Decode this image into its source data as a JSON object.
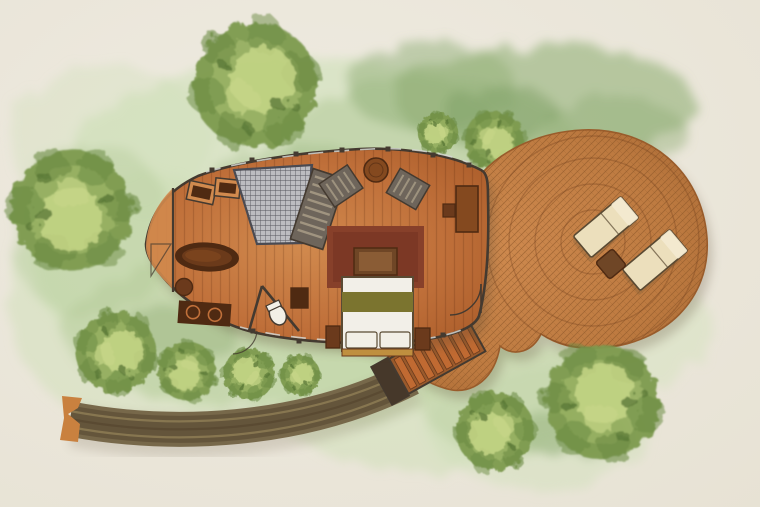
{
  "meta": {
    "title": "Watercolor top-down site plan of an oval treehouse cabin with round sun deck, staircase and curved boardwalk through a lawn with trees",
    "type": "illustrated-floor-plan",
    "style": "watercolor"
  },
  "counts": {
    "trees": 10,
    "sun_loungers": 2,
    "stair_steps": 8,
    "sinks": 2,
    "armchairs": 2,
    "pillows": 2,
    "nightstands": 2
  },
  "elements": {
    "site": [
      "lawn-wash",
      "trees",
      "curved-boardwalk",
      "boardwalk-end-cap"
    ],
    "cabin": [
      "oval-cabin-hull",
      "tip-balcony",
      "entry-grate",
      "slatted-daybed",
      "armchair-left",
      "armchair-right",
      "round-side-table",
      "console-table",
      "wall-stool",
      "storage-boxes",
      "bathtub",
      "bath-stool",
      "vanity-double-sink",
      "toilet-room",
      "toilet",
      "bath-cabinet",
      "area-rug",
      "ottoman",
      "double-bed",
      "bed-pillows",
      "nightstands",
      "interior-door",
      "bathroom-door"
    ],
    "deck": [
      "round-deck",
      "sun-loungers",
      "lounger-side-table",
      "staircase"
    ]
  },
  "colors": {
    "paper": "#efebe1",
    "paper_edge": "#e7e2d4",
    "wash_light": "#cfe0b8",
    "wash_mid": "#aec893",
    "wash_dark": "#92b077",
    "wash_deep": "#7fa065",
    "tree_light": "#c6d687",
    "tree_mid": "#93ad5b",
    "tree_dark": "#6c8c44",
    "tree_deep": "#4f6e2e",
    "floor_light": "#d18a4e",
    "floor_mid": "#c0703a",
    "floor_dark": "#a85a28",
    "plank_line": "rgba(70,30,5,0.18)",
    "deck_light": "#cf8a4f",
    "deck_mid": "#bd7a40",
    "deck_dark": "#9a5c2b",
    "deck_hatch": "#8a5526",
    "deck_arc": "rgba(110,60,25,0.30)",
    "wall": "#443a30",
    "glazing": "#d5d7d2",
    "rug": "#87402a",
    "rug_inner": "#7a3724",
    "ottoman": "#6f4626",
    "ottoman_top": "#8a5c35",
    "bed_linen": "#f2efe8",
    "bed_blanket": "#7b742f",
    "bed_foot": "#bf8f3f",
    "night_wood": "#6b3a1c",
    "dark_wood": "#4f2a12",
    "mid_wood": "#84491f",
    "tub_rim": "#4f2a12",
    "tub_inner": "#6b3a1a",
    "grate": "#bcbcc0",
    "grate_line": "#4a4a52",
    "slat_gray": "#6e655b",
    "slat_light": "#a69a85",
    "lounger": "#ecdfbc",
    "lounger_head": "#f4ead0",
    "lounger_edge": "#5a4a33",
    "bridge": "#77684a",
    "bridge_dark": "#55462f",
    "bridge_light": "#8d7c55",
    "bridge_cap": "#c9813f",
    "stair_rail": "#9a5a2c",
    "stair_tread": "#c06a32",
    "stair_dark": "#46382a",
    "fixture_white": "#f2efe6",
    "shadow": "#5a4a32"
  }
}
